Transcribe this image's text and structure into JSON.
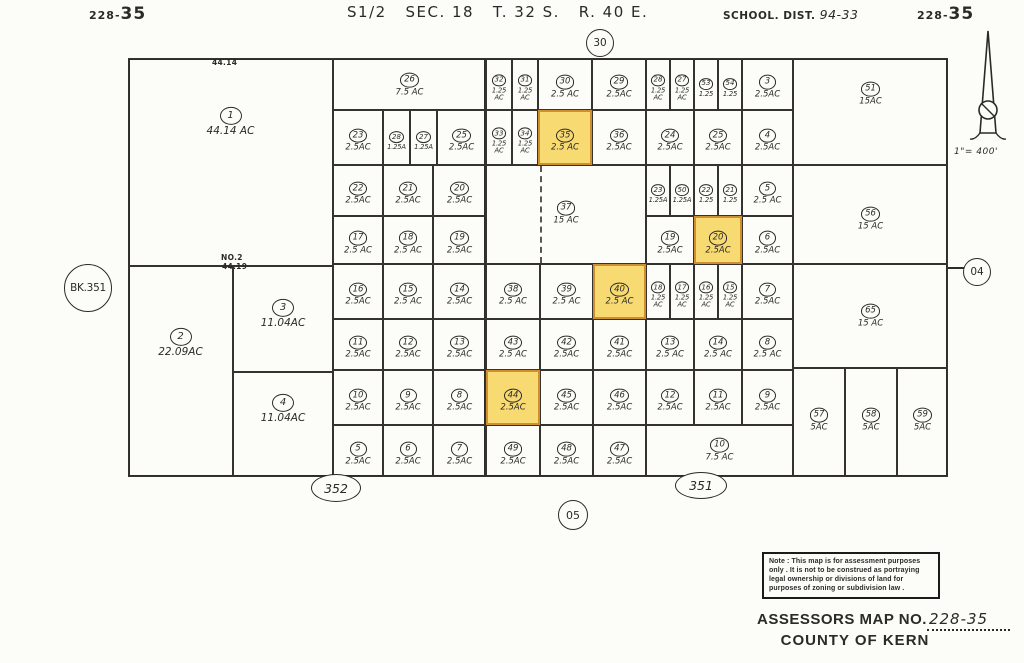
{
  "header": {
    "sheet_left_small": "228-",
    "sheet_left_big": "35",
    "title": "S1/2   SEC. 18   T. 32 S.   R. 40 E.",
    "school_label": "SCHOOL.  DIST.",
    "school_value": "94-33",
    "sheet_right_small": "228-",
    "sheet_right_big": "35"
  },
  "refs": {
    "top": "30",
    "bottom": "05",
    "right": "04",
    "book": "BK.351",
    "bottom_left": "352",
    "bottom_right": "351"
  },
  "annotations": {
    "dim_top": "44.14",
    "no2": "NO.2",
    "dim_mid": "44.19"
  },
  "scale_text": "1\"= 400'",
  "note_text": "Note : This map is for assessment purposes\nonly . It is not to be construed as portraying\nlegal ownership or divisions of land for\npurposes of zoning or subdivision law .",
  "footer": {
    "assessors_label": "ASSESSORS  MAP  NO.",
    "map_no": "228-35",
    "county": "COUNTY  OF  KERN"
  },
  "colors": {
    "highlight_fill": "#f7da72",
    "highlight_border": "#cf8f2e",
    "line": "#2e2c28"
  },
  "highlighted_parcels": [
    "35",
    "20",
    "40",
    "44"
  ],
  "parcels": [
    {
      "n": "1",
      "a": "44.14 AC",
      "x": 128,
      "y": 58,
      "w": 205,
      "h": 208,
      "ly": 119,
      "big": true
    },
    {
      "n": "2",
      "a": "22.09AC",
      "x": 128,
      "y": 266,
      "w": 105,
      "h": 211,
      "ly": 340,
      "big": true
    },
    {
      "n": "3",
      "a": "11.04AC",
      "x": 233,
      "y": 266,
      "w": 100,
      "h": 106,
      "ly": 311,
      "big": true
    },
    {
      "n": "4",
      "a": "11.04AC",
      "x": 233,
      "y": 372,
      "w": 100,
      "h": 105,
      "ly": 406,
      "big": true
    },
    {
      "n": "26",
      "a": "7.5 AC",
      "x": 333,
      "y": 58,
      "w": 153,
      "h": 52,
      "ly": 81
    },
    {
      "n": "37",
      "a": "15 AC",
      "x": 486,
      "y": 165,
      "w": 160,
      "h": 99,
      "ly": 209
    },
    {
      "n": "51",
      "a": "15AC",
      "x": 793,
      "y": 58,
      "w": 155,
      "h": 107,
      "ly": 90
    },
    {
      "n": "56",
      "a": "15 AC",
      "x": 793,
      "y": 165,
      "w": 155,
      "h": 99,
      "ly": 215
    },
    {
      "n": "65",
      "a": "15 AC",
      "x": 793,
      "y": 264,
      "w": 155,
      "h": 104,
      "ly": 312
    },
    {
      "n": "57",
      "a": "5AC",
      "x": 793,
      "y": 368,
      "w": 52,
      "h": 109,
      "ly": 416
    },
    {
      "n": "58",
      "a": "5AC",
      "x": 845,
      "y": 368,
      "w": 52,
      "h": 109,
      "ly": 416
    },
    {
      "n": "59",
      "a": "5AC",
      "x": 897,
      "y": 368,
      "w": 51,
      "h": 109,
      "ly": 416
    },
    {
      "n": "32",
      "a": "1.25\nAC",
      "x": 486,
      "y": 58,
      "w": 26,
      "h": 52,
      "narrow": true
    },
    {
      "n": "31",
      "a": "1.25\nAC",
      "x": 512,
      "y": 58,
      "w": 26,
      "h": 52,
      "narrow": true
    },
    {
      "n": "30",
      "a": "2.5 AC",
      "x": 538,
      "y": 58,
      "w": 54,
      "h": 52
    },
    {
      "n": "29",
      "a": "2.5AC",
      "x": 592,
      "y": 58,
      "w": 54,
      "h": 52
    },
    {
      "n": "28",
      "a": "1.25\nAC",
      "x": 646,
      "y": 58,
      "w": 24,
      "h": 52,
      "narrow": true
    },
    {
      "n": "27",
      "a": "1.25\nAC",
      "x": 670,
      "y": 58,
      "w": 24,
      "h": 52,
      "narrow": true
    },
    {
      "n": "53",
      "a": "1.25",
      "x": 694,
      "y": 58,
      "w": 24,
      "h": 52,
      "narrow": true
    },
    {
      "n": "54",
      "a": "1.25",
      "x": 718,
      "y": 58,
      "w": 24,
      "h": 52,
      "narrow": true
    },
    {
      "n": "3",
      "a": "2.5AC",
      "x": 742,
      "y": 58,
      "w": 51,
      "h": 52
    },
    {
      "n": "23",
      "a": "2.5AC",
      "x": 333,
      "y": 110,
      "w": 50,
      "h": 55
    },
    {
      "n": "28",
      "a": "1.25A",
      "x": 383,
      "y": 110,
      "w": 27,
      "h": 55,
      "narrow": true
    },
    {
      "n": "27",
      "a": "1.25A",
      "x": 410,
      "y": 110,
      "w": 27,
      "h": 55,
      "narrow": true
    },
    {
      "n": "25",
      "a": "2.5AC",
      "x": 437,
      "y": 110,
      "w": 49,
      "h": 55
    },
    {
      "n": "33",
      "a": "1.25\nAC",
      "x": 486,
      "y": 110,
      "w": 26,
      "h": 55,
      "narrow": true
    },
    {
      "n": "34",
      "a": "1.25\nAC",
      "x": 512,
      "y": 110,
      "w": 26,
      "h": 55,
      "narrow": true
    },
    {
      "n": "35",
      "a": "2.5 AC",
      "x": 538,
      "y": 110,
      "w": 54,
      "h": 55,
      "hl": true
    },
    {
      "n": "36",
      "a": "2.5AC",
      "x": 592,
      "y": 110,
      "w": 54,
      "h": 55
    },
    {
      "n": "24",
      "a": "2.5AC",
      "x": 646,
      "y": 110,
      "w": 48,
      "h": 55
    },
    {
      "n": "25",
      "a": "2.5AC",
      "x": 694,
      "y": 110,
      "w": 48,
      "h": 55
    },
    {
      "n": "4",
      "a": "2.5AC",
      "x": 742,
      "y": 110,
      "w": 51,
      "h": 55
    },
    {
      "n": "22",
      "a": "2.5AC",
      "x": 333,
      "y": 165,
      "w": 50,
      "h": 51
    },
    {
      "n": "21",
      "a": "2.5AC",
      "x": 383,
      "y": 165,
      "w": 50,
      "h": 51
    },
    {
      "n": "20",
      "a": "2.5AC",
      "x": 433,
      "y": 165,
      "w": 53,
      "h": 51
    },
    {
      "n": "23",
      "a": "1.25A",
      "x": 646,
      "y": 165,
      "w": 24,
      "h": 51,
      "narrow": true
    },
    {
      "n": "50",
      "a": "1.25A",
      "x": 670,
      "y": 165,
      "w": 24,
      "h": 51,
      "narrow": true
    },
    {
      "n": "22",
      "a": "1.25",
      "x": 694,
      "y": 165,
      "w": 24,
      "h": 51,
      "narrow": true
    },
    {
      "n": "21",
      "a": "1.25",
      "x": 718,
      "y": 165,
      "w": 24,
      "h": 51,
      "narrow": true
    },
    {
      "n": "5",
      "a": "2.5 AC",
      "x": 742,
      "y": 165,
      "w": 51,
      "h": 51
    },
    {
      "n": "17",
      "a": "2.5 AC",
      "x": 333,
      "y": 216,
      "w": 50,
      "h": 48
    },
    {
      "n": "18",
      "a": "2.5 AC",
      "x": 383,
      "y": 216,
      "w": 50,
      "h": 48
    },
    {
      "n": "19",
      "a": "2.5AC",
      "x": 433,
      "y": 216,
      "w": 53,
      "h": 48
    },
    {
      "n": "19",
      "a": "2.5AC",
      "x": 646,
      "y": 216,
      "w": 48,
      "h": 48
    },
    {
      "n": "20",
      "a": "2.5AC",
      "x": 694,
      "y": 216,
      "w": 48,
      "h": 48,
      "hl": true
    },
    {
      "n": "6",
      "a": "2.5AC",
      "x": 742,
      "y": 216,
      "w": 51,
      "h": 48
    },
    {
      "n": "16",
      "a": "2.5AC",
      "x": 333,
      "y": 264,
      "w": 50,
      "h": 55
    },
    {
      "n": "15",
      "a": "2.5 AC",
      "x": 383,
      "y": 264,
      "w": 50,
      "h": 55
    },
    {
      "n": "14",
      "a": "2.5AC",
      "x": 433,
      "y": 264,
      "w": 53,
      "h": 55
    },
    {
      "n": "38",
      "a": "2.5 AC",
      "x": 486,
      "y": 264,
      "w": 54,
      "h": 55
    },
    {
      "n": "39",
      "a": "2.5 AC",
      "x": 540,
      "y": 264,
      "w": 53,
      "h": 55
    },
    {
      "n": "40",
      "a": "2.5 AC",
      "x": 593,
      "y": 264,
      "w": 53,
      "h": 55,
      "hl": true
    },
    {
      "n": "18",
      "a": "1.25\nAC",
      "x": 646,
      "y": 264,
      "w": 24,
      "h": 55,
      "narrow": true
    },
    {
      "n": "17",
      "a": "1.25\nAC",
      "x": 670,
      "y": 264,
      "w": 24,
      "h": 55,
      "narrow": true
    },
    {
      "n": "16",
      "a": "1.25\nAC",
      "x": 694,
      "y": 264,
      "w": 24,
      "h": 55,
      "narrow": true
    },
    {
      "n": "15",
      "a": "1.25\nAC",
      "x": 718,
      "y": 264,
      "w": 24,
      "h": 55,
      "narrow": true
    },
    {
      "n": "7",
      "a": "2.5AC",
      "x": 742,
      "y": 264,
      "w": 51,
      "h": 55
    },
    {
      "n": "11",
      "a": "2.5AC",
      "x": 333,
      "y": 319,
      "w": 50,
      "h": 51
    },
    {
      "n": "12",
      "a": "2.5AC",
      "x": 383,
      "y": 319,
      "w": 50,
      "h": 51
    },
    {
      "n": "13",
      "a": "2.5AC",
      "x": 433,
      "y": 319,
      "w": 53,
      "h": 51
    },
    {
      "n": "43",
      "a": "2.5 AC",
      "x": 486,
      "y": 319,
      "w": 54,
      "h": 51
    },
    {
      "n": "42",
      "a": "2.5AC",
      "x": 540,
      "y": 319,
      "w": 53,
      "h": 51
    },
    {
      "n": "41",
      "a": "2.5AC",
      "x": 593,
      "y": 319,
      "w": 53,
      "h": 51
    },
    {
      "n": "13",
      "a": "2.5 AC",
      "x": 646,
      "y": 319,
      "w": 48,
      "h": 51
    },
    {
      "n": "14",
      "a": "2.5 AC",
      "x": 694,
      "y": 319,
      "w": 48,
      "h": 51
    },
    {
      "n": "8",
      "a": "2.5 AC",
      "x": 742,
      "y": 319,
      "w": 51,
      "h": 51
    },
    {
      "n": "10",
      "a": "2.5AC",
      "x": 333,
      "y": 370,
      "w": 50,
      "h": 55
    },
    {
      "n": "9",
      "a": "2.5AC",
      "x": 383,
      "y": 370,
      "w": 50,
      "h": 55
    },
    {
      "n": "8",
      "a": "2.5AC",
      "x": 433,
      "y": 370,
      "w": 53,
      "h": 55
    },
    {
      "n": "44",
      "a": "2.5AC",
      "x": 486,
      "y": 370,
      "w": 54,
      "h": 55,
      "hl": true
    },
    {
      "n": "45",
      "a": "2.5AC",
      "x": 540,
      "y": 370,
      "w": 53,
      "h": 55
    },
    {
      "n": "46",
      "a": "2.5AC",
      "x": 593,
      "y": 370,
      "w": 53,
      "h": 55
    },
    {
      "n": "12",
      "a": "2.5AC",
      "x": 646,
      "y": 370,
      "w": 48,
      "h": 55
    },
    {
      "n": "11",
      "a": "2.5AC",
      "x": 694,
      "y": 370,
      "w": 48,
      "h": 55
    },
    {
      "n": "9",
      "a": "2.5AC",
      "x": 742,
      "y": 370,
      "w": 51,
      "h": 55
    },
    {
      "n": "5",
      "a": "2.5AC",
      "x": 333,
      "y": 425,
      "w": 50,
      "h": 52
    },
    {
      "n": "6",
      "a": "2.5AC",
      "x": 383,
      "y": 425,
      "w": 50,
      "h": 52
    },
    {
      "n": "7",
      "a": "2.5AC",
      "x": 433,
      "y": 425,
      "w": 53,
      "h": 52
    },
    {
      "n": "49",
      "a": "2.5AC",
      "x": 486,
      "y": 425,
      "w": 54,
      "h": 52
    },
    {
      "n": "48",
      "a": "2.5AC",
      "x": 540,
      "y": 425,
      "w": 53,
      "h": 52
    },
    {
      "n": "47",
      "a": "2.5AC",
      "x": 593,
      "y": 425,
      "w": 53,
      "h": 52
    },
    {
      "n": "10",
      "a": "7.5 AC",
      "x": 646,
      "y": 425,
      "w": 147,
      "h": 52,
      "ly": 446
    }
  ]
}
